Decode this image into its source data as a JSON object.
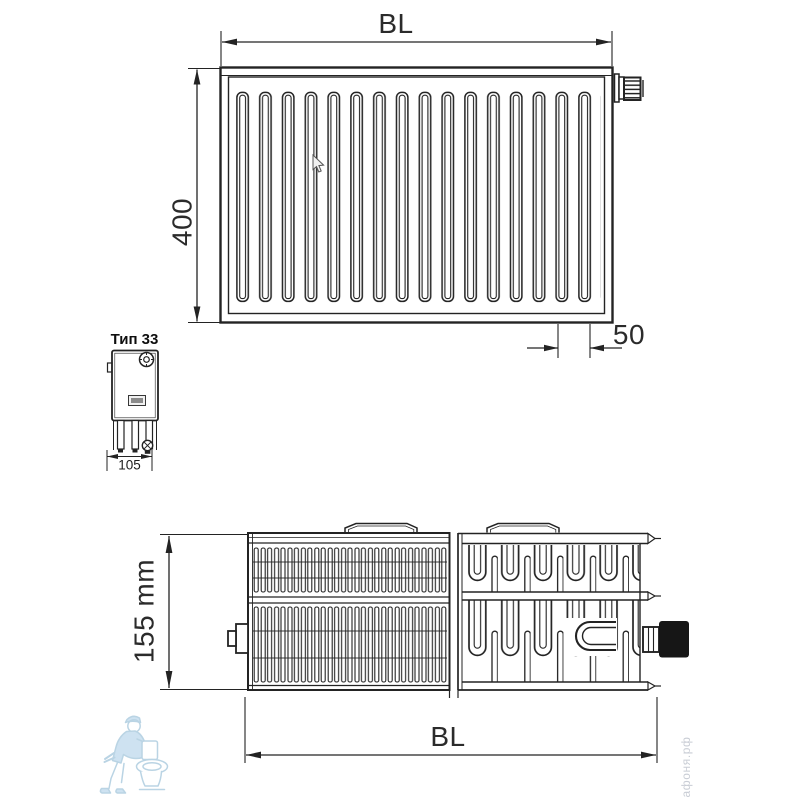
{
  "labels": {
    "front_width_top": "BL",
    "front_height": "400",
    "tapping_offset": "50",
    "type_name": "Тип 33",
    "side_depth": "105",
    "section_height": "155 mm",
    "section_width": "BL"
  },
  "drawing": {
    "line_color": "#232323",
    "front_view_slot_count": 16
  },
  "watermark": {
    "brand_text": "афоня.рф",
    "brand_text_color": "#c9cdd5",
    "mascot_icon": "plumber-with-toilet",
    "mascot_color": "#a9cade"
  },
  "cursor_icon": "mouse-pointer"
}
